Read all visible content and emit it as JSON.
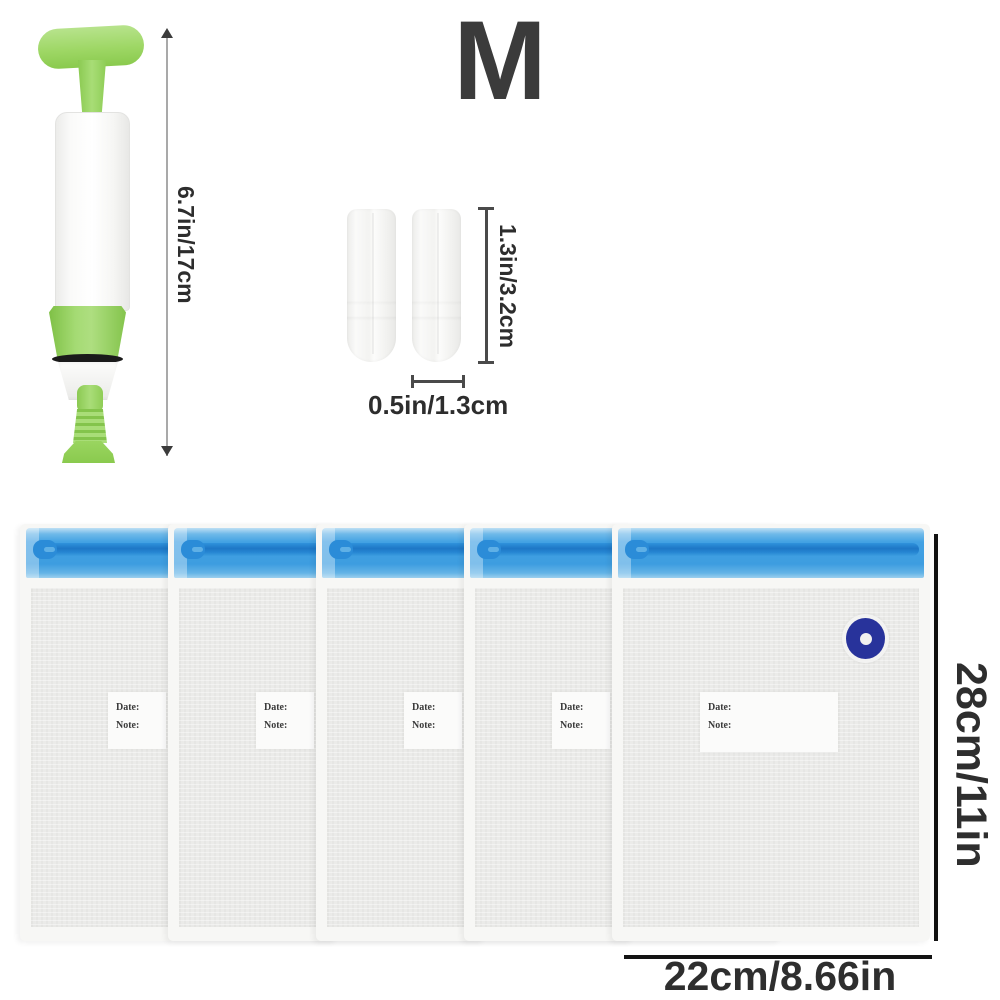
{
  "size_label": "M",
  "pump": {
    "height_dimension": "6.7in/17cm"
  },
  "clips": {
    "height_dimension": "1.3in/3.2cm",
    "width_dimension": "0.5in/1.3cm"
  },
  "bags": {
    "height_dimension": "28cm/11in",
    "width_dimension": "22cm/8.66in",
    "items": [
      {
        "date_label": "Date:",
        "note_label": "Note:"
      },
      {
        "date_label": "Date:",
        "note_label": "Note:"
      },
      {
        "date_label": "Date:",
        "note_label": "Note:"
      },
      {
        "date_label": "Date:",
        "note_label": "Note:"
      },
      {
        "date_label": "Date:",
        "note_label": "Note:"
      }
    ]
  },
  "colors": {
    "bag_blue": "#41a0e2",
    "zipper_blue": "#1e77c6",
    "pump_green": "#9ed765",
    "valve_navy": "#28339b",
    "dimension_text": "#2d2d2d",
    "dimension_line": "#131313"
  }
}
